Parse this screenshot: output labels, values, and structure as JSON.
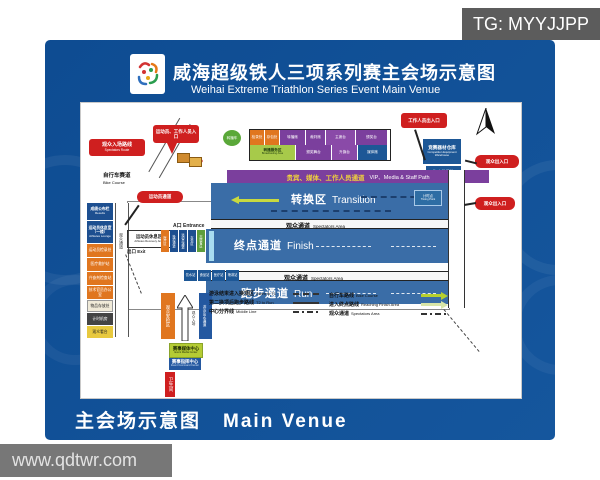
{
  "page": {
    "tg_badge": "TG: MYYJJPP",
    "watermark": "www.qdtwr.com",
    "colors": {
      "panel_blue": "#0f4f97",
      "band_blue": "#3a6da7",
      "vip_purple": "#7b3f9d",
      "callout_red": "#cf1f1f",
      "orange": "#e0761f",
      "yellow_green": "#c8d93f",
      "finish_line": "#a8dcf0",
      "navy": "#1d4f90",
      "green": "#5f9e3c"
    }
  },
  "header": {
    "title_cn": "威海超级铁人三项系列赛主会场示意图",
    "title_en": "Weihai Extreme Triathlon Series Event Main Venue"
  },
  "footer": {
    "label_cn": "主会场示意图",
    "label_en": "Main Venue"
  },
  "venue": {
    "vip_path_cn": "贵宾、媒体、工作人员通道",
    "vip_path_en": "VIP、Media & Staff Path",
    "transition_cn": "转换区",
    "transition_en": "Transition",
    "spectators_cn": "观众通道",
    "spectators_en": "Spectators Area",
    "finish_cn": "终点通道",
    "finish_en": "Finish",
    "run_cn": "跑步通道",
    "run_en": "Run",
    "bike_course_cn": "自行车赛道",
    "bike_course_en": "Bike Course",
    "entrance_a": "A口 Entrance",
    "exit": "出口 Exit",
    "athletes_recovery_cn": "运动员休息区",
    "athletes_recovery_en": "Athletes Recovery Area",
    "timing_point_cn": "计时点",
    "timing_point_en": "Timing Point",
    "warehouse_cn": "竞赛器材仓库",
    "warehouse_en": "Competition Equipment Warehouse",
    "sea_rescue_cn": "海上救援队",
    "sea_rescue_en": "Sea Rescue",
    "tv_van": "转播车",
    "stage_row1": [
      "检录处",
      "存包处",
      "转播席",
      "裁判席",
      "主席台",
      "颁奖台"
    ],
    "stage_row2_lead_cn": "转播服务区",
    "stage_row2_lead_en": "Broadcasting Area",
    "stage_row2": [
      "颁奖舞台",
      "升旗台",
      "媒体席"
    ],
    "service_stations": [
      "饮水站",
      "食品站",
      "医疗站",
      "喷淋站"
    ],
    "slats": [
      "医疗区",
      "换项通道",
      "运动员通道",
      "存包区",
      "志愿者区"
    ]
  },
  "callouts": {
    "athletes_entrance": "运动员、工作人员入口",
    "spectators_route_cn": "观众入场路线",
    "spectators_route_en": "Spectators Route",
    "staff_gate": "工作人员出入口",
    "spectator_gate1": "观众出入口",
    "spectator_gate2": "观众出入口",
    "athletes_path": "运动员通道"
  },
  "left_column": [
    {
      "cn": "成绩公布栏",
      "en": "Results"
    },
    {
      "cn": "运动员休息室（一楼）",
      "en": "Athletes Lounge"
    },
    {
      "cn": "运动员检录处"
    },
    {
      "cn": "医疗救护站"
    },
    {
      "cn": "兴奋剂检查站"
    },
    {
      "cn": "技术官员办公室"
    },
    {
      "cn": "物品存放处"
    },
    {
      "cn": "计时机房"
    },
    {
      "cn": "观众看台"
    }
  ],
  "bottom": {
    "security_check": "观众安检区",
    "spectator_entry": "观众入场",
    "swim_exit": "游泳出水通道",
    "media_center_cn": "赛事媒体中心",
    "media_center_en": "Event Media Center",
    "command_center_cn": "赛事指挥中心",
    "command_center_en": "Event Command Center",
    "restroom": "卫生间"
  },
  "legend": {
    "left": [
      {
        "cn": "游泳结束进入换项区",
        "en": "Swim to T1"
      },
      {
        "cn": "第二换项后跑步路线",
        "en": "T2 to Run"
      },
      {
        "cn": "中心分界线",
        "en": "Middle Line"
      }
    ],
    "right": [
      {
        "cn": "自行车路线",
        "en": "Bike Course"
      },
      {
        "cn": "进入终点路线",
        "en": "Reaching Finish Area"
      },
      {
        "cn": "观众通道",
        "en": "Spectators Area"
      }
    ]
  }
}
